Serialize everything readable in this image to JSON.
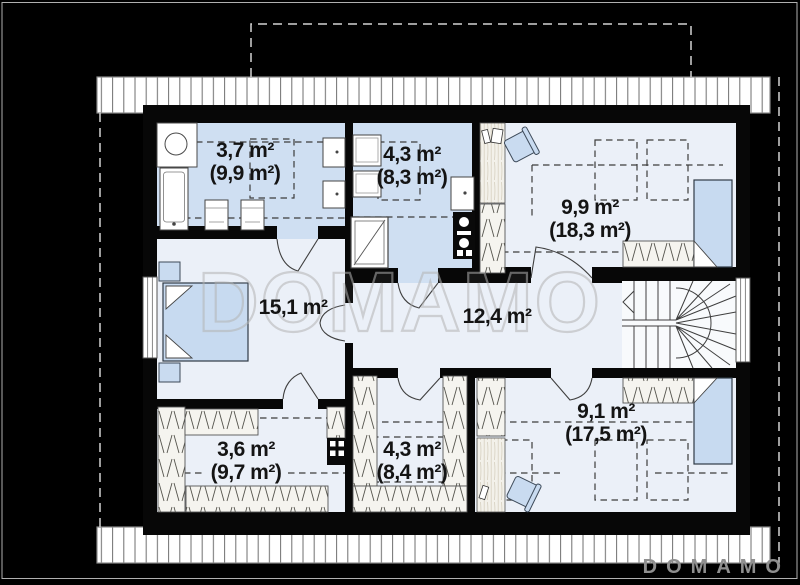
{
  "watermark": {
    "text": "DOMAMO"
  },
  "brand": {
    "logo_text": "DOMAMO"
  },
  "rooms": [
    {
      "id": "bathroom-top-left",
      "area": "3,7 m²",
      "area_total": "(9,9 m²)"
    },
    {
      "id": "bathroom-top-middle",
      "area": "4,3 m²",
      "area_total": "(8,3 m²)"
    },
    {
      "id": "bedroom-top-right",
      "area": "9,9 m²",
      "area_total": "(18,3 m²)"
    },
    {
      "id": "bedroom-left",
      "area": "15,1 m²"
    },
    {
      "id": "hall-center",
      "area": "12,4 m²"
    },
    {
      "id": "wardrobe-bottom-left",
      "area": "3,6 m²",
      "area_total": "(9,7 m²)"
    },
    {
      "id": "wardrobe-bottom-mid",
      "area": "4,3 m²",
      "area_total": "(8,4 m²)"
    },
    {
      "id": "bedroom-bottom-right",
      "area": "9,1 m²",
      "area_total": "(17,5 m²)"
    }
  ],
  "colors": {
    "background": "#000000",
    "bath_floor": "#cfdff2",
    "room_floor": "#ebf0f8",
    "bed_fill": "#c7daf0",
    "watermark_gray": "#b4b4b4",
    "logo_gray": "#8f8f8f"
  }
}
